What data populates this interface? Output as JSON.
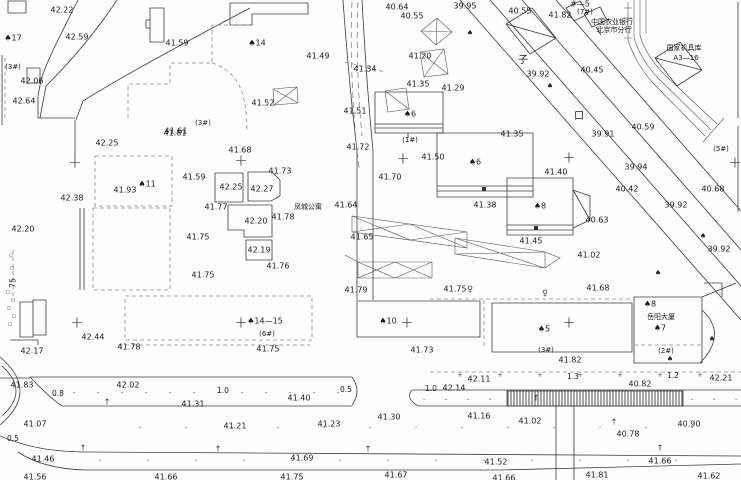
{
  "map": {
    "type": "topographic-survey-plan",
    "colors": {
      "ink": "#3c3c3c",
      "dashed_boundary": "#8a8a8a",
      "label": "#1a1a1a",
      "paper": "#fefefe"
    },
    "labels": [
      [
        62,
        10,
        "42.22",
        "elev"
      ],
      [
        77,
        37,
        "42.59",
        "elev"
      ],
      [
        13,
        38,
        "♠17",
        "bldg"
      ],
      [
        177,
        43,
        "41.59",
        "elev"
      ],
      [
        257,
        43,
        "♠14",
        "bldg"
      ],
      [
        13,
        67,
        "(3#)",
        "annot"
      ],
      [
        32,
        81,
        "42.06",
        "elev"
      ],
      [
        24,
        101,
        "42.64",
        "elev"
      ],
      [
        203,
        123,
        "(3#)",
        "annot"
      ],
      [
        176,
        131,
        "41.61",
        "elev"
      ],
      [
        107,
        143,
        "42.25",
        "elev"
      ],
      [
        175,
        133,
        "41.81",
        "elev"
      ],
      [
        318,
        56,
        "41.49",
        "elev"
      ],
      [
        263,
        103,
        "41.52",
        "elev"
      ],
      [
        355,
        111,
        "41.51",
        "elev"
      ],
      [
        365,
        69,
        "41.34",
        "elev"
      ],
      [
        397,
        7,
        "40.64",
        "elev"
      ],
      [
        412,
        16,
        "40.55",
        "elev"
      ],
      [
        465,
        6,
        "39.95",
        "elev"
      ],
      [
        420,
        56,
        "41.20",
        "elev"
      ],
      [
        418,
        84,
        "41.35",
        "elev"
      ],
      [
        453,
        88,
        "41.29",
        "elev"
      ],
      [
        520,
        11,
        "40.55",
        "elev"
      ],
      [
        560,
        15,
        "41.82",
        "elev"
      ],
      [
        580,
        4,
        "#—5",
        "bldg"
      ],
      [
        585,
        12,
        "(7#)",
        "annot"
      ],
      [
        612,
        22,
        "中国农业银行",
        "cn"
      ],
      [
        614,
        30,
        "北京市分行",
        "cn"
      ],
      [
        684,
        48,
        "国家机具库",
        "cn"
      ],
      [
        686,
        58,
        "A3—16",
        "cn"
      ],
      [
        592,
        70,
        "40.45",
        "elev"
      ],
      [
        538,
        74,
        "39.92",
        "elev"
      ],
      [
        523,
        60,
        "子",
        "street"
      ],
      [
        579,
        116,
        "口",
        "street"
      ],
      [
        643,
        127,
        "40.59",
        "elev"
      ],
      [
        603,
        134,
        "39.91",
        "elev"
      ],
      [
        721,
        149,
        "(5#)",
        "annot"
      ],
      [
        636,
        167,
        "39.94",
        "elev"
      ],
      [
        627,
        189,
        "40.42",
        "elev"
      ],
      [
        713,
        189,
        "40.68",
        "elev"
      ],
      [
        676,
        205,
        "39.92",
        "elev"
      ],
      [
        719,
        249,
        "39.92",
        "elev"
      ],
      [
        240,
        150,
        "41.68",
        "elev"
      ],
      [
        280,
        171,
        "41.73",
        "elev"
      ],
      [
        194,
        177,
        "41.59",
        "elev"
      ],
      [
        231,
        187,
        "42.25",
        "elev"
      ],
      [
        262,
        189,
        "42.27",
        "elev"
      ],
      [
        125,
        190,
        "41.93",
        "elev"
      ],
      [
        72,
        198,
        "42.38",
        "elev"
      ],
      [
        147,
        184,
        "♠11",
        "bldg"
      ],
      [
        216,
        207,
        "41.77",
        "elev"
      ],
      [
        256,
        221,
        "42.20",
        "elev"
      ],
      [
        283,
        217,
        "41.78",
        "elev"
      ],
      [
        198,
        237,
        "41.75",
        "elev"
      ],
      [
        259,
        250,
        "42.19",
        "elev"
      ],
      [
        278,
        266,
        "41.76",
        "elev"
      ],
      [
        203,
        275,
        "41.75",
        "elev"
      ],
      [
        23,
        229,
        "42.20",
        "elev"
      ],
      [
        13,
        283,
        "75",
        "elev",
        -90
      ],
      [
        410,
        114,
        "♠6",
        "bldg"
      ],
      [
        410,
        140,
        "(1#)",
        "annot"
      ],
      [
        358,
        147,
        "41.72",
        "elev"
      ],
      [
        433,
        157,
        "41.50",
        "elev"
      ],
      [
        390,
        177,
        "41.70",
        "elev"
      ],
      [
        346,
        205,
        "41.64",
        "elev"
      ],
      [
        308,
        207,
        "凤城公寓",
        "cn"
      ],
      [
        362,
        237,
        "41.65",
        "elev"
      ],
      [
        356,
        290,
        "41.79",
        "elev"
      ],
      [
        455,
        289,
        "41.75",
        "elev"
      ],
      [
        512,
        134,
        "41.35",
        "elev"
      ],
      [
        475,
        162,
        "♠6",
        "bldg"
      ],
      [
        485,
        205,
        "41.38",
        "elev"
      ],
      [
        540,
        206,
        "♠8",
        "bldg"
      ],
      [
        556,
        172,
        "41.40",
        "elev"
      ],
      [
        531,
        241,
        "41.45",
        "elev"
      ],
      [
        597,
        220,
        "40.63",
        "elev"
      ],
      [
        589,
        255,
        "41.02",
        "elev"
      ],
      [
        598,
        288,
        "41.68",
        "elev"
      ],
      [
        32,
        351,
        "42.17",
        "elev"
      ],
      [
        93,
        337,
        "42.44",
        "elev"
      ],
      [
        129,
        347,
        "41.78",
        "elev"
      ],
      [
        22,
        385,
        "41.83",
        "elev"
      ],
      [
        58,
        394,
        "0.8",
        "dim"
      ],
      [
        128,
        385,
        "42.02",
        "elev"
      ],
      [
        223,
        391,
        "1.0",
        "dim"
      ],
      [
        193,
        404,
        "41.31",
        "elev"
      ],
      [
        35,
        424,
        "41.07",
        "elev"
      ],
      [
        235,
        426,
        "41.21",
        "elev"
      ],
      [
        13,
        439,
        "0.5",
        "dim"
      ],
      [
        43,
        459,
        "41.46",
        "elev"
      ],
      [
        35,
        477,
        "41.56",
        "elev"
      ],
      [
        166,
        477,
        "41.66",
        "elev"
      ],
      [
        292,
        477,
        "41.75",
        "elev"
      ],
      [
        302,
        458,
        "41.69",
        "elev"
      ],
      [
        329,
        424,
        "41.23",
        "elev"
      ],
      [
        299,
        398,
        "41.40",
        "elev"
      ],
      [
        346,
        390,
        "0.5",
        "dim"
      ],
      [
        389,
        417,
        "41.30",
        "elev"
      ],
      [
        396,
        475,
        "41.67",
        "elev"
      ],
      [
        265,
        321,
        "♠14—15",
        "bldg"
      ],
      [
        267,
        334,
        "(6#)",
        "annot"
      ],
      [
        388,
        321,
        "♠10",
        "bldg"
      ],
      [
        268,
        349,
        "41.75",
        "elev"
      ],
      [
        422,
        350,
        "41.73",
        "elev"
      ],
      [
        479,
        379,
        "42.11",
        "elev"
      ],
      [
        454,
        388,
        "42.14",
        "elev"
      ],
      [
        431,
        389,
        "1.0",
        "dim"
      ],
      [
        479,
        416,
        "41.16",
        "elev"
      ],
      [
        544,
        329,
        "♠5",
        "bldg"
      ],
      [
        546,
        350,
        "(3#)",
        "annot"
      ],
      [
        570,
        360,
        "41.82",
        "elev"
      ],
      [
        650,
        304,
        "♠8",
        "bldg"
      ],
      [
        661,
        317,
        "岳阳大厦",
        "cn"
      ],
      [
        660,
        328,
        "♠7",
        "bldg"
      ],
      [
        666,
        351,
        "(2#)",
        "annot"
      ],
      [
        573,
        377,
        "1.3",
        "dim"
      ],
      [
        673,
        376,
        "1.2",
        "dim"
      ],
      [
        721,
        378,
        "42.21",
        "elev"
      ],
      [
        640,
        384,
        "40.82",
        "elev"
      ],
      [
        530,
        421,
        "41.02",
        "elev"
      ],
      [
        689,
        424,
        "40.90",
        "elev"
      ],
      [
        628,
        434,
        "40.78",
        "elev"
      ],
      [
        496,
        462,
        "41.52",
        "elev"
      ],
      [
        660,
        461,
        "41.66",
        "elev"
      ],
      [
        597,
        475,
        "41.81",
        "elev"
      ],
      [
        709,
        476,
        "41.62",
        "elev"
      ],
      [
        504,
        478,
        "41.66",
        "elev"
      ]
    ],
    "symbols": {
      "cross": [
        [
          75,
          163
        ],
        [
          77,
          323
        ],
        [
          241,
          161
        ],
        [
          241,
          323
        ],
        [
          403,
          159
        ],
        [
          407,
          323
        ],
        [
          569,
          158
        ],
        [
          569,
          323
        ],
        [
          735,
          163
        ]
      ],
      "tree": [
        [
          470,
          33
        ],
        [
          550,
          86
        ],
        [
          703,
          236
        ],
        [
          658,
          273
        ],
        [
          712,
          339
        ],
        [
          670,
          359
        ]
      ],
      "flag": [
        [
          470,
          289
        ],
        [
          545,
          293
        ]
      ],
      "up": [
        [
          107,
          402
        ],
        [
          83,
          448
        ],
        [
          218,
          449
        ],
        [
          368,
          449
        ],
        [
          536,
          398
        ],
        [
          614,
          422
        ],
        [
          660,
          448
        ]
      ],
      "circ": [
        [
          11,
          255
        ],
        [
          12,
          268
        ],
        [
          8,
          292
        ],
        [
          13,
          300
        ],
        [
          9,
          308
        ],
        [
          14,
          316
        ],
        [
          10,
          324
        ]
      ]
    },
    "texture_rows": [
      {
        "g": "·",
        "y": 393,
        "x0": 74,
        "x1": 344,
        "s": 24
      },
      {
        "g": "·",
        "y": 400,
        "x0": 424,
        "x1": 500,
        "s": 22
      },
      {
        "g": "·",
        "y": 400,
        "x0": 692,
        "x1": 738,
        "s": 22
      },
      {
        "g": "·",
        "y": 428,
        "x0": 140,
        "x1": 720,
        "s": 46
      },
      {
        "g": "·",
        "y": 461,
        "x0": 100,
        "x1": 700,
        "s": 48
      },
      {
        "g": "+",
        "y": 375,
        "x0": 460,
        "x1": 700,
        "s": 40
      }
    ]
  }
}
